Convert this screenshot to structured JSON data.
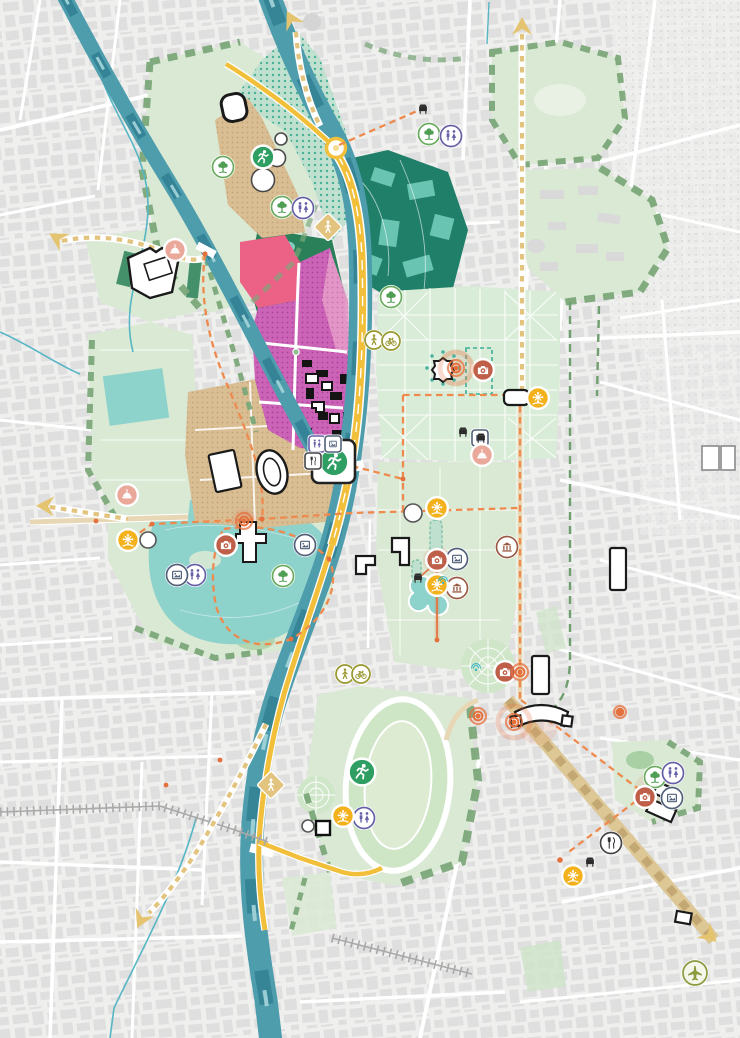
{
  "map": {
    "kind": "urban-masterplan-map",
    "description": "stylized city green-framework masterplan with river, parks, routes and POI icons",
    "palette": {
      "bg": "#efefee",
      "fabric": "#dcdcdc",
      "street": "#ffffff",
      "river": "#4d9dad",
      "riverDark": "#2e7d90",
      "riverLight": "#a6d6da",
      "stream": "#56b6c4",
      "lake": "#8ed2cc",
      "parkPale": "#d9e9d4",
      "parkPale2": "#cde4c7",
      "parkMed": "#a9cfa5",
      "parkDark": "#2a8159",
      "parkTeal": "#1f7f68",
      "tealShape": "#6fc8b6",
      "hatchGreen": "#7ca87a",
      "dotTealBase": "#bfe0cf",
      "dotTeal": "#3fae92",
      "pinkSolid": "#ec6186",
      "magentaBase": "#cb63b7",
      "magentaDot": "#ad3f9b",
      "pinkLightBase": "#e59bc8",
      "pinkLightDot": "#cf7ab2",
      "tanBase": "#d9bd93",
      "tanDot": "#c3a172",
      "tanRoad": "#e7d7b4",
      "boulevard": "#dcc795",
      "boulevardDash": "#c3a873",
      "yellowRoad": "#f2bf3a",
      "orangeRoute": "#ee8a4d",
      "orangeDot": "#e4713d",
      "dashTan": "#e2c47e",
      "greenDash": "#6f9e6f",
      "rail": "#a9a9a9",
      "iconGreen": "#2f9e63",
      "iconTreeRing": "#6aaa5f",
      "iconTree": "#4f9e53",
      "iconPurple": "#655fa6",
      "iconTerracotta": "#bf5f49",
      "iconYellow": "#f3b11b",
      "iconBrown": "#9a5b45",
      "iconFrame": "#51607a",
      "iconOlive": "#98982f",
      "iconPlane": "#8a9a3d",
      "iconSalmon": "#e9a89a",
      "iconBlack": "#2b2b2b",
      "target": "#e4713d",
      "arrowTan": "#e5c471",
      "fountain": "#3db6c2",
      "white": "#ffffff"
    },
    "icon_legend": {
      "run": "sports-running-area",
      "tree": "park-green-space",
      "wc": "public-toilets",
      "camera": "photo-landmark",
      "sun": "attraction-wheel",
      "frame": "museum-gallery",
      "bank": "heritage-building",
      "restaurant": "food-point",
      "dome": "religious-landmark",
      "bike": "bike-route-point",
      "walk": "pedestrian-route-point",
      "walk-diamond": "pedestrian-crossing-sign",
      "plane": "airport-direction",
      "target": "key-development-node",
      "bench": "small-landmark-building",
      "fountain": "fountain",
      "plain-circle": "minor-poi",
      "square-building": "building-footprint",
      "route-arrow": "route-direction-arrow"
    },
    "markers": [
      {
        "type": "route-arrow",
        "x": 291,
        "y": 19,
        "rot": -28
      },
      {
        "type": "route-arrow",
        "x": 522,
        "y": 26,
        "rot": 0
      },
      {
        "type": "route-arrow",
        "x": 45,
        "y": 506,
        "rot": -88
      },
      {
        "type": "route-arrow",
        "x": 57,
        "y": 238,
        "rot": -60
      },
      {
        "type": "route-arrow",
        "x": 141,
        "y": 920,
        "rot": -155
      },
      {
        "type": "route-arrow",
        "x": 710,
        "y": 936,
        "rot": 132
      },
      {
        "type": "run",
        "x": 263,
        "y": 157,
        "s": 11
      },
      {
        "type": "run",
        "x": 334,
        "y": 462,
        "s": 14
      },
      {
        "type": "run",
        "x": 362,
        "y": 772,
        "s": 13
      },
      {
        "type": "tree",
        "x": 223,
        "y": 167
      },
      {
        "type": "tree",
        "x": 282,
        "y": 207
      },
      {
        "type": "tree",
        "x": 429,
        "y": 134
      },
      {
        "type": "tree",
        "x": 391,
        "y": 297
      },
      {
        "type": "tree",
        "x": 283,
        "y": 576
      },
      {
        "type": "tree",
        "x": 655,
        "y": 777
      },
      {
        "type": "wc",
        "x": 303,
        "y": 208
      },
      {
        "type": "wc",
        "x": 451,
        "y": 136
      },
      {
        "type": "wc",
        "x": 195,
        "y": 575
      },
      {
        "type": "wc",
        "x": 364,
        "y": 818
      },
      {
        "type": "wc",
        "x": 673,
        "y": 773
      },
      {
        "type": "wc",
        "x": 317,
        "y": 444,
        "sq": true,
        "s": 8
      },
      {
        "type": "frame",
        "x": 333,
        "y": 444,
        "sq": true,
        "s": 8
      },
      {
        "type": "restaurant",
        "x": 313,
        "y": 461,
        "sq": true,
        "s": 8
      },
      {
        "type": "frame",
        "x": 177,
        "y": 575
      },
      {
        "type": "frame",
        "x": 305,
        "y": 545
      },
      {
        "type": "frame",
        "x": 457,
        "y": 559
      },
      {
        "type": "frame",
        "x": 672,
        "y": 798
      },
      {
        "type": "frame",
        "x": 480,
        "y": 438,
        "sq": true,
        "s": 8
      },
      {
        "type": "bank",
        "x": 507,
        "y": 547
      },
      {
        "type": "bank",
        "x": 457,
        "y": 588
      },
      {
        "type": "camera",
        "x": 226,
        "y": 545
      },
      {
        "type": "camera",
        "x": 437,
        "y": 560
      },
      {
        "type": "camera",
        "x": 483,
        "y": 370
      },
      {
        "type": "camera",
        "x": 505,
        "y": 672
      },
      {
        "type": "camera",
        "x": 645,
        "y": 797
      },
      {
        "type": "sun",
        "x": 128,
        "y": 540
      },
      {
        "type": "sun",
        "x": 343,
        "y": 816
      },
      {
        "type": "sun",
        "x": 437,
        "y": 508
      },
      {
        "type": "sun",
        "x": 437,
        "y": 585
      },
      {
        "type": "sun",
        "x": 538,
        "y": 398
      },
      {
        "type": "sun",
        "x": 573,
        "y": 876
      },
      {
        "type": "dome",
        "x": 175,
        "y": 250
      },
      {
        "type": "dome",
        "x": 127,
        "y": 495
      },
      {
        "type": "dome",
        "x": 482,
        "y": 455
      },
      {
        "type": "restaurant",
        "x": 611,
        "y": 843
      },
      {
        "type": "walk",
        "x": 374,
        "y": 340,
        "s": 9
      },
      {
        "type": "bike",
        "x": 391,
        "y": 341,
        "s": 9
      },
      {
        "type": "walk",
        "x": 345,
        "y": 674,
        "s": 9
      },
      {
        "type": "bike",
        "x": 361,
        "y": 674,
        "s": 9
      },
      {
        "type": "walk-diamond",
        "x": 328,
        "y": 227
      },
      {
        "type": "walk-diamond",
        "x": 271,
        "y": 785
      },
      {
        "type": "plane",
        "x": 695,
        "y": 973,
        "s": 12
      },
      {
        "type": "target",
        "x": 456,
        "y": 368,
        "big": true
      },
      {
        "type": "target",
        "x": 244,
        "y": 521
      },
      {
        "type": "target",
        "x": 520,
        "y": 672
      },
      {
        "type": "target",
        "x": 478,
        "y": 716
      },
      {
        "type": "target",
        "x": 514,
        "y": 722,
        "big": true
      },
      {
        "type": "target",
        "x": 620,
        "y": 712,
        "s": 6
      },
      {
        "type": "bench",
        "x": 423,
        "y": 108
      },
      {
        "type": "bench",
        "x": 463,
        "y": 431
      },
      {
        "type": "bench",
        "x": 481,
        "y": 437
      },
      {
        "type": "bench",
        "x": 590,
        "y": 861
      },
      {
        "type": "bench",
        "x": 418,
        "y": 577
      },
      {
        "type": "fountain",
        "x": 476,
        "y": 667
      },
      {
        "type": "fountain",
        "x": 443,
        "y": 580
      },
      {
        "type": "plain-circle",
        "x": 148,
        "y": 540,
        "s": 8
      },
      {
        "type": "plain-circle",
        "x": 413,
        "y": 513,
        "s": 9
      },
      {
        "type": "plain-circle",
        "x": 308,
        "y": 826,
        "s": 6
      },
      {
        "type": "square-building",
        "x": 323,
        "y": 828,
        "s": 7
      }
    ]
  }
}
